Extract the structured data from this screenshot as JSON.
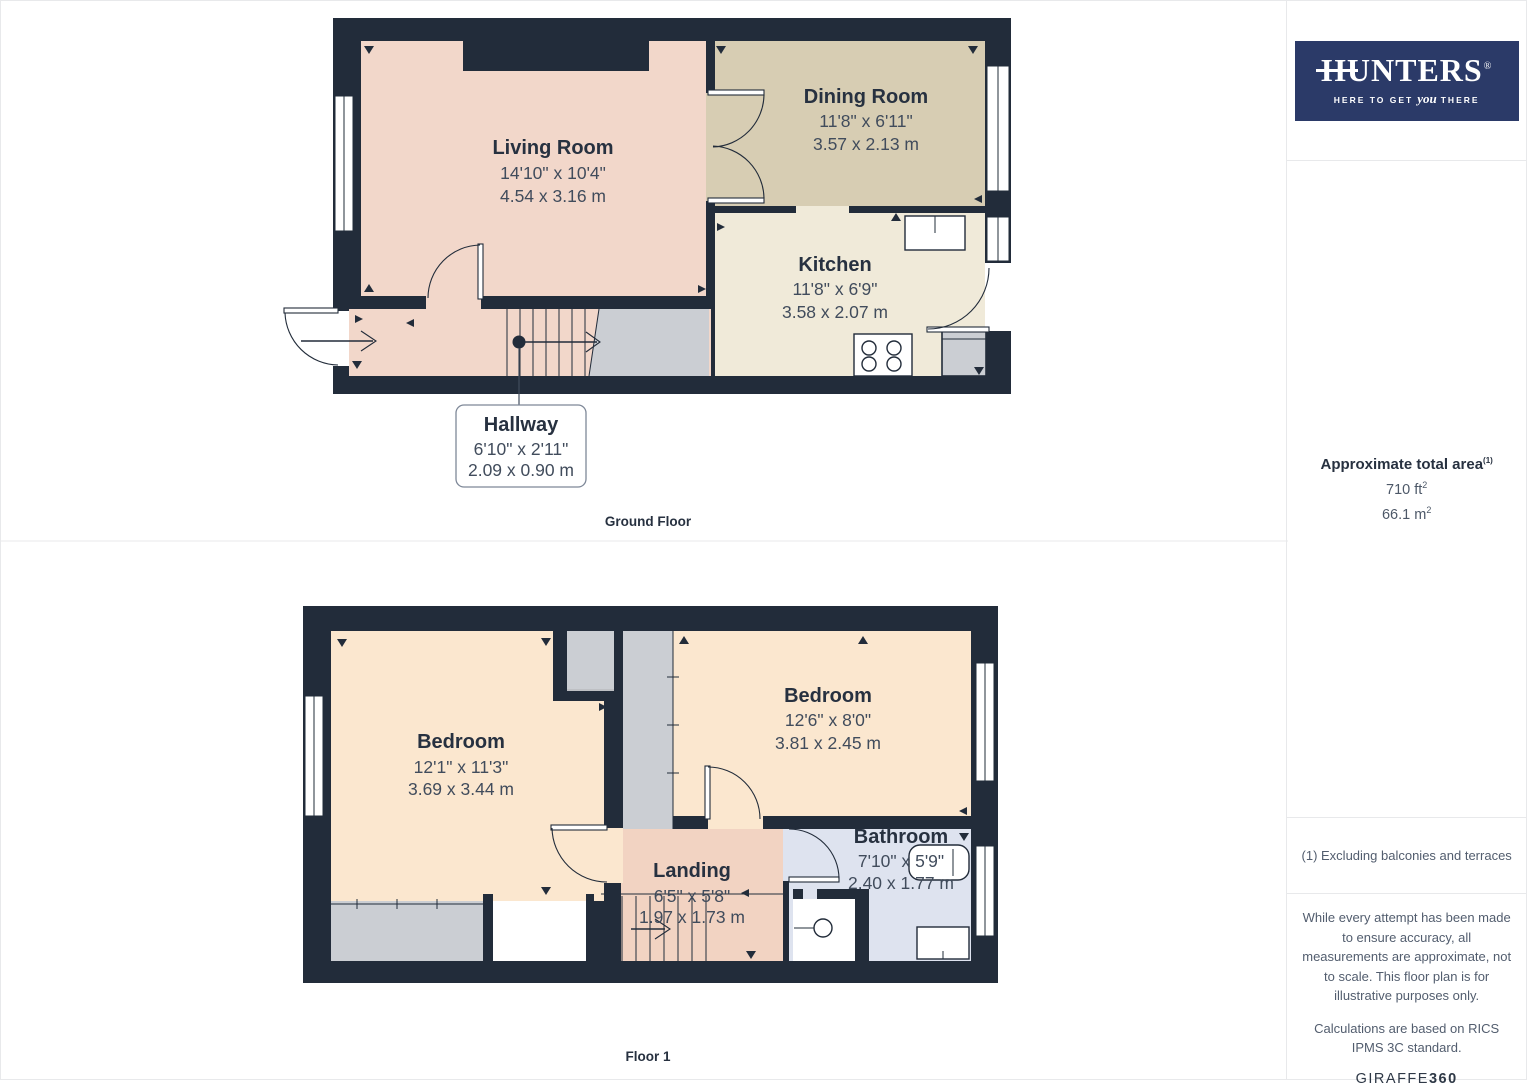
{
  "brand": {
    "logo_text": "HUNTERS",
    "registered_mark": "®",
    "tagline_pre": "HERE TO GET",
    "tagline_emphasis": "you",
    "tagline_post": "THERE"
  },
  "sidebar": {
    "area_title": "Approximate total area",
    "area_title_sup": "(1)",
    "area_imperial": "710 ft",
    "area_imperial_sup": "2",
    "area_metric": "66.1 m",
    "area_metric_sup": "2",
    "footnote": "(1) Excluding balconies and terraces",
    "disclaimer_1": "While every attempt has been made to ensure accuracy, all measurements are approximate, not to scale. This floor plan is for illustrative purposes only.",
    "disclaimer_2": "Calculations are based on RICS IPMS 3C standard.",
    "credit_brand": "GIRAFFE",
    "credit_brand_bold": "360"
  },
  "floors": {
    "ground": {
      "label": "Ground Floor",
      "rooms": {
        "living": {
          "name": "Living Room",
          "imperial": "14'10\" x 10'4\"",
          "metric": "4.54 x 3.16 m"
        },
        "dining": {
          "name": "Dining Room",
          "imperial": "11'8\" x 6'11\"",
          "metric": "3.57 x 2.13 m"
        },
        "kitchen": {
          "name": "Kitchen",
          "imperial": "11'8\" x 6'9\"",
          "metric": "3.58 x 2.07 m"
        },
        "hallway": {
          "name": "Hallway",
          "imperial": "6'10\" x 2'11\"",
          "metric": "2.09 x 0.90 m"
        }
      }
    },
    "first": {
      "label": "Floor 1",
      "rooms": {
        "bedroom1": {
          "name": "Bedroom",
          "imperial": "12'1\" x 11'3\"",
          "metric": "3.69 x 3.44 m"
        },
        "bedroom2": {
          "name": "Bedroom",
          "imperial": "12'6\" x 8'0\"",
          "metric": "3.81 x 2.45 m"
        },
        "landing": {
          "name": "Landing",
          "imperial": "6'5\" x 5'8\"",
          "metric": "1.97 x 1.73 m"
        },
        "bathroom": {
          "name": "Bathroom",
          "imperial": "7'10\" x 5'9\"",
          "metric": "2.40 x 1.77 m"
        }
      }
    }
  },
  "colors": {
    "wall": "#222c3a",
    "living_room": "#f2d7ca",
    "dining_room": "#d7cdb3",
    "kitchen": "#f0ead9",
    "hallway": "#f2d7ca",
    "bedroom": "#fbe7cf",
    "landing": "#f2d3c2",
    "bathroom": "#dee3ef",
    "stairs_grey": "#cbced3",
    "logo_navy": "#2b3a68",
    "text_dark": "#273140",
    "text_dim": "#414c5c"
  }
}
